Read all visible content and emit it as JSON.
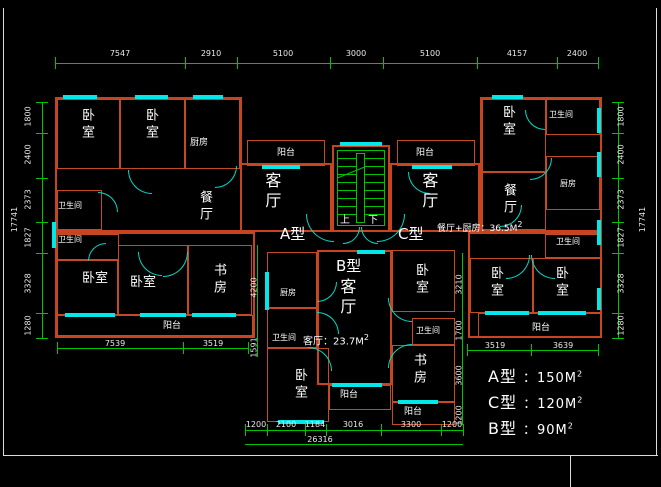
{
  "colors": {
    "wall": "#c8441f",
    "window": "#00e8e8",
    "dimension": "#00c400",
    "text": "#ffffff",
    "background": "#000000"
  },
  "dims": {
    "top": [
      "7547",
      "2910",
      "5100",
      "3000",
      "5100",
      "4157",
      "2400"
    ],
    "left": [
      "1800",
      "2400",
      "2373",
      "1827",
      "3328",
      "1280"
    ],
    "left_total": "17741",
    "right": [
      "1800",
      "2400",
      "2373",
      "1827",
      "3328",
      "1280"
    ],
    "right_total": "17741",
    "bottom": [
      "1200",
      "2100",
      "1184",
      "3016",
      "3300",
      "1200"
    ],
    "bottom_total": "26316",
    "bottom_left": [
      "7539",
      "3519"
    ],
    "bottom_right": [
      "3519",
      "3639"
    ],
    "inner_left": [
      "4200",
      "1591"
    ],
    "inner_right": [
      "3210",
      "1700",
      "3600",
      "1200"
    ]
  },
  "rooms": {
    "bedroom": "卧室",
    "kitchen": "厨房",
    "dining": "餐厅",
    "living": "客厅",
    "bath": "卫生间",
    "balcony": "阳台",
    "study": "书房"
  },
  "units": {
    "a": "A型",
    "b": "B型",
    "c": "C型"
  },
  "annotations": {
    "dining_kitchen": {
      "text": "餐厅+厨房：36.5M",
      "sup": "2"
    },
    "living_b": {
      "text": "客厅：23.7M",
      "sup": "2"
    },
    "up": "上",
    "down": "下"
  },
  "legend": [
    {
      "label": "A型",
      "sep": "：",
      "value": "150M",
      "sup": "2"
    },
    {
      "label": "C型",
      "sep": "：",
      "value": "120M",
      "sup": "2"
    },
    {
      "label": "B型",
      "sep": "：",
      "value": "90M",
      "sup": "2"
    }
  ]
}
